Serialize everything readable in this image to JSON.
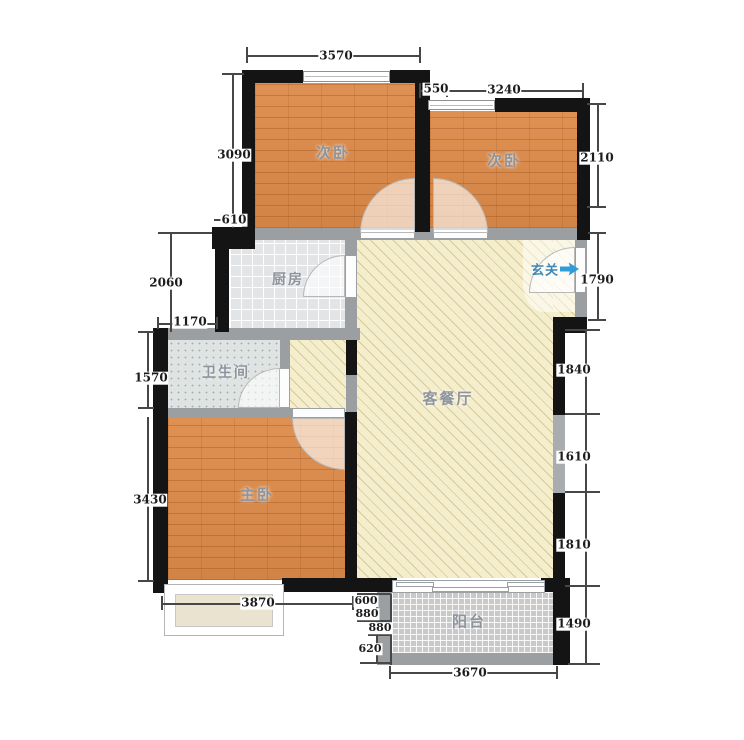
{
  "rooms": {
    "bedroom_top_left": "次卧",
    "bedroom_top_right": "次卧",
    "kitchen": "厨房",
    "entry": "玄关",
    "bathroom": "卫生间",
    "living_dining": "客餐厅",
    "master_bedroom": "主卧",
    "balcony": "阳台"
  },
  "dims": {
    "top_3570": "3570",
    "top_550": "550",
    "top_3240": "3240",
    "left_3090": "3090",
    "left_610": "610",
    "left_2060": "2060",
    "left_1170": "1170",
    "left_1570": "1570",
    "left_3430": "3430",
    "right_2110": "2110",
    "right_1790": "1790",
    "right_1840": "1840",
    "right_1610": "1610",
    "right_1810": "1810",
    "right_1490": "1490",
    "bottom_3870": "3870",
    "bottom_600": "600",
    "bottom_880_inner": "880",
    "bottom_880_outer": "880",
    "bottom_620": "620",
    "bottom_3670": "3670"
  },
  "colors": {
    "wall_black": "#141414",
    "wall_gray": "#9b9fa2",
    "wood_floor": "#dd8a49",
    "living_floor": "#f5eecd",
    "kitchen_floor": "#e3e4e6",
    "bathroom_floor": "#dfe4e3",
    "balcony_floor": "#c9c9c9",
    "entry_accent_blue": "#2f9cd8"
  }
}
